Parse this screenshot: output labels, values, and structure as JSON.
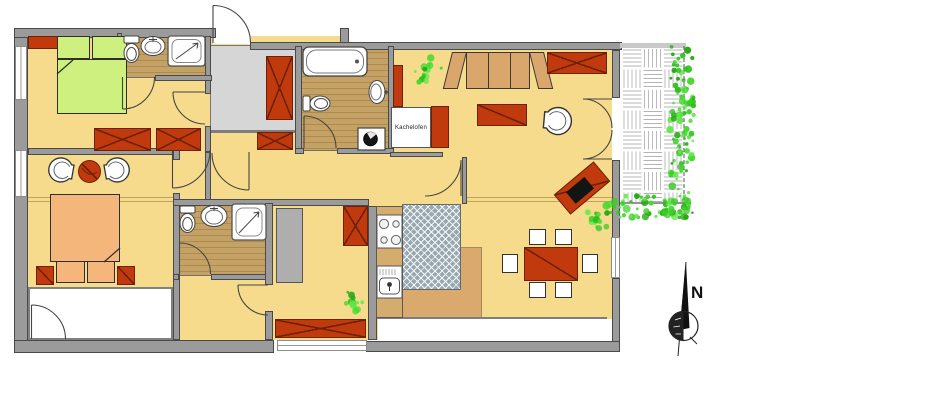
{
  "labels": {
    "stove": "Kachelofen",
    "compass_north": "N"
  },
  "colors": {
    "floor": "#f6db8d",
    "wall": "#9b9b9b",
    "wall_edge": "#4a4a4a",
    "wood_floor": "#c4a164",
    "entry_floor": "#d6d6d6",
    "furniture_red": "#c03a0e",
    "furniture_red_dark": "#6e2104",
    "bed_green": "#cdf07e",
    "bed_orange": "#f5b67c",
    "wood_furniture": "#d9a76b",
    "kitchen_floor": "#d9a96e",
    "rug_gray": "#97a8b0",
    "plant_green": "#3bcb27",
    "line_dark": "#3d3d3d"
  }
}
